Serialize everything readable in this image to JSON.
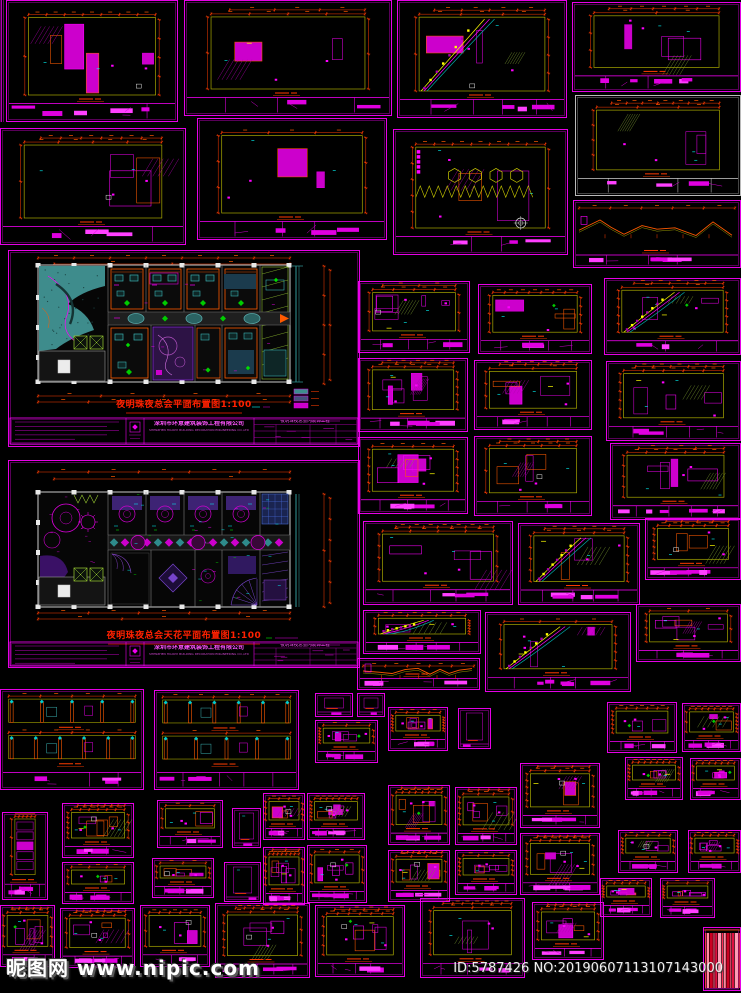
{
  "page": {
    "background": "#000000",
    "width": 741,
    "height": 993
  },
  "watermark": {
    "site_name": "昵图网",
    "site_url": "www.nipic.com",
    "image_id": "ID:5787426 NO:20190607113107143000"
  },
  "plans": {
    "p1": {
      "title": "夜明珠夜总会平面布置图1:100",
      "scale": "1:100",
      "type": "floor-plan"
    },
    "p2": {
      "title": "夜明珠夜总会天花平面布置图1:100",
      "scale": "1:100",
      "type": "ceiling-plan"
    }
  },
  "title_block": {
    "company_cn": "深圳市环意建筑装饰工程有限公司",
    "company_en": "SHENZHEN HUANYI BUILDING DECORATION ENGINEERING CO.,LTD",
    "project": "夜明珠夜总会内装饰工程"
  },
  "colors": {
    "sheet_border": "#ff00ff",
    "sheet_border_inner": "#b000b0",
    "white_border": "#cfcfcf",
    "dimension_red": "#ff3c00",
    "dimension_orange": "#ff5a00",
    "outline_olive": "#a8a800",
    "accent_cyan": "#00ffff",
    "accent_yellow": "#ffff00",
    "accent_green": "#00cc00",
    "teal_fill": "#3e8c8c",
    "violet": "#7744cc",
    "magenta_fill": "#cc00cc",
    "plan_title_red": "#ff2000",
    "swatch_pink": "#ff2a55"
  },
  "sheets": [
    {
      "x": 0,
      "y": 0,
      "w": 5,
      "h": 122,
      "b": "m",
      "k": "edge",
      "s": 1
    },
    {
      "x": 6,
      "y": 0,
      "w": 172,
      "h": 122,
      "b": "m",
      "k": "elev",
      "s": 11
    },
    {
      "x": 184,
      "y": 0,
      "w": 208,
      "h": 116,
      "b": "m",
      "k": "elev",
      "s": 12
    },
    {
      "x": 397,
      "y": 0,
      "w": 170,
      "h": 118,
      "b": "m",
      "k": "elevC",
      "s": 13
    },
    {
      "x": 572,
      "y": 2,
      "w": 169,
      "h": 90,
      "b": "m",
      "k": "elev",
      "s": 14
    },
    {
      "x": 0,
      "y": 128,
      "w": 186,
      "h": 117,
      "b": "m",
      "k": "elev",
      "s": 15
    },
    {
      "x": 197,
      "y": 118,
      "w": 190,
      "h": 122,
      "b": "m",
      "k": "elev",
      "s": 16
    },
    {
      "x": 393,
      "y": 129,
      "w": 175,
      "h": 126,
      "b": "m",
      "k": "elevH",
      "s": 17
    },
    {
      "x": 575,
      "y": 95,
      "w": 166,
      "h": 101,
      "b": "w",
      "k": "elev",
      "s": 18
    },
    {
      "x": 573,
      "y": 200,
      "w": 168,
      "h": 68,
      "b": "m",
      "k": "section",
      "s": 19
    },
    {
      "x": 8,
      "y": 250,
      "w": 352,
      "h": 197,
      "b": "m",
      "k": "plan1",
      "s": 0
    },
    {
      "x": 8,
      "y": 460,
      "w": 352,
      "h": 208,
      "b": "m",
      "k": "plan2",
      "s": 0
    },
    {
      "x": 358,
      "y": 281,
      "w": 112,
      "h": 72,
      "b": "m",
      "k": "elev",
      "s": 21
    },
    {
      "x": 478,
      "y": 284,
      "w": 114,
      "h": 70,
      "b": "m",
      "k": "elev",
      "s": 22
    },
    {
      "x": 358,
      "y": 358,
      "w": 110,
      "h": 74,
      "b": "m",
      "k": "elev",
      "s": 23
    },
    {
      "x": 474,
      "y": 360,
      "w": 118,
      "h": 70,
      "b": "m",
      "k": "elev",
      "s": 24
    },
    {
      "x": 358,
      "y": 437,
      "w": 110,
      "h": 77,
      "b": "m",
      "k": "elev",
      "s": 25
    },
    {
      "x": 474,
      "y": 436,
      "w": 118,
      "h": 80,
      "b": "m",
      "k": "elev",
      "s": 26
    },
    {
      "x": 604,
      "y": 278,
      "w": 137,
      "h": 77,
      "b": "m",
      "k": "elevC",
      "s": 27
    },
    {
      "x": 606,
      "y": 361,
      "w": 135,
      "h": 80,
      "b": "m",
      "k": "elev",
      "s": 28
    },
    {
      "x": 610,
      "y": 443,
      "w": 131,
      "h": 77,
      "b": "m",
      "k": "elev",
      "s": 29
    },
    {
      "x": 363,
      "y": 521,
      "w": 150,
      "h": 84,
      "b": "m",
      "k": "elev",
      "s": 30
    },
    {
      "x": 518,
      "y": 523,
      "w": 122,
      "h": 82,
      "b": "m",
      "k": "elevC",
      "s": 31
    },
    {
      "x": 645,
      "y": 518,
      "w": 96,
      "h": 62,
      "b": "m",
      "k": "elev",
      "s": 32
    },
    {
      "x": 363,
      "y": 610,
      "w": 118,
      "h": 44,
      "b": "m",
      "k": "elevC",
      "s": 34
    },
    {
      "x": 485,
      "y": 612,
      "w": 146,
      "h": 80,
      "b": "m",
      "k": "elevC",
      "s": 35
    },
    {
      "x": 636,
      "y": 604,
      "w": 105,
      "h": 58,
      "b": "m",
      "k": "elev",
      "s": 36
    },
    {
      "x": 357,
      "y": 658,
      "w": 123,
      "h": 32,
      "b": "m",
      "k": "section",
      "s": 37
    },
    {
      "x": 0,
      "y": 689,
      "w": 144,
      "h": 101,
      "b": "m",
      "k": "long2",
      "s": 38
    },
    {
      "x": 154,
      "y": 690,
      "w": 145,
      "h": 100,
      "b": "m",
      "k": "long2",
      "s": 39
    },
    {
      "x": 315,
      "y": 693,
      "w": 38,
      "h": 24,
      "b": "m",
      "k": "tiny",
      "s": 40
    },
    {
      "x": 357,
      "y": 693,
      "w": 28,
      "h": 24,
      "b": "m",
      "k": "tiny",
      "s": 41
    },
    {
      "x": 315,
      "y": 720,
      "w": 63,
      "h": 43,
      "b": "m",
      "k": "elev",
      "s": 42
    },
    {
      "x": 388,
      "y": 707,
      "w": 60,
      "h": 44,
      "b": "m",
      "k": "elev",
      "s": 43
    },
    {
      "x": 458,
      "y": 708,
      "w": 33,
      "h": 41,
      "b": "m",
      "k": "tiny",
      "s": 44
    },
    {
      "x": 607,
      "y": 702,
      "w": 70,
      "h": 51,
      "b": "m",
      "k": "elev",
      "s": 45
    },
    {
      "x": 682,
      "y": 703,
      "w": 59,
      "h": 49,
      "b": "m",
      "k": "elev",
      "s": 46
    },
    {
      "x": 625,
      "y": 757,
      "w": 58,
      "h": 43,
      "b": "m",
      "k": "elev",
      "s": 47
    },
    {
      "x": 690,
      "y": 758,
      "w": 51,
      "h": 42,
      "b": "m",
      "k": "elev",
      "s": 48
    },
    {
      "x": 263,
      "y": 793,
      "w": 42,
      "h": 47,
      "b": "m",
      "k": "elev",
      "s": 49
    },
    {
      "x": 307,
      "y": 793,
      "w": 58,
      "h": 47,
      "b": "m",
      "k": "elev",
      "s": 50
    },
    {
      "x": 263,
      "y": 847,
      "w": 42,
      "h": 58,
      "b": "m",
      "k": "elev",
      "s": 51
    },
    {
      "x": 307,
      "y": 845,
      "w": 60,
      "h": 58,
      "b": "m",
      "k": "elev",
      "s": 52
    },
    {
      "x": 388,
      "y": 785,
      "w": 62,
      "h": 60,
      "b": "m",
      "k": "elev",
      "s": 53
    },
    {
      "x": 388,
      "y": 850,
      "w": 62,
      "h": 52,
      "b": "m",
      "k": "elev",
      "s": 54
    },
    {
      "x": 455,
      "y": 787,
      "w": 62,
      "h": 58,
      "b": "m",
      "k": "elev",
      "s": 55
    },
    {
      "x": 455,
      "y": 850,
      "w": 62,
      "h": 45,
      "b": "m",
      "k": "elev",
      "s": 56
    },
    {
      "x": 520,
      "y": 763,
      "w": 80,
      "h": 65,
      "b": "m",
      "k": "elev",
      "s": 57
    },
    {
      "x": 520,
      "y": 833,
      "w": 80,
      "h": 62,
      "b": "m",
      "k": "elev",
      "s": 58
    },
    {
      "x": 2,
      "y": 812,
      "w": 46,
      "h": 88,
      "b": "m",
      "k": "tall",
      "s": 59
    },
    {
      "x": 62,
      "y": 803,
      "w": 72,
      "h": 55,
      "b": "m",
      "k": "elev",
      "s": 60
    },
    {
      "x": 62,
      "y": 862,
      "w": 72,
      "h": 42,
      "b": "m",
      "k": "elev",
      "s": 61
    },
    {
      "x": 157,
      "y": 800,
      "w": 66,
      "h": 48,
      "b": "m",
      "k": "elev",
      "s": 62
    },
    {
      "x": 232,
      "y": 808,
      "w": 29,
      "h": 40,
      "b": "m",
      "k": "tiny",
      "s": 63
    },
    {
      "x": 152,
      "y": 858,
      "w": 62,
      "h": 40,
      "b": "m",
      "k": "elev",
      "s": 64
    },
    {
      "x": 224,
      "y": 862,
      "w": 37,
      "h": 40,
      "b": "m",
      "k": "tiny",
      "s": 65
    },
    {
      "x": 618,
      "y": 830,
      "w": 60,
      "h": 43,
      "b": "m",
      "k": "elev",
      "s": 66
    },
    {
      "x": 688,
      "y": 830,
      "w": 53,
      "h": 43,
      "b": "m",
      "k": "elev",
      "s": 67
    },
    {
      "x": 600,
      "y": 878,
      "w": 52,
      "h": 39,
      "b": "m",
      "k": "elev",
      "s": 68
    },
    {
      "x": 660,
      "y": 878,
      "w": 55,
      "h": 40,
      "b": "m",
      "k": "elev",
      "s": 69
    },
    {
      "x": 0,
      "y": 905,
      "w": 55,
      "h": 62,
      "b": "m",
      "k": "elev",
      "s": 70
    },
    {
      "x": 60,
      "y": 908,
      "w": 75,
      "h": 60,
      "b": "m",
      "k": "elev",
      "s": 71
    },
    {
      "x": 140,
      "y": 905,
      "w": 70,
      "h": 62,
      "b": "m",
      "k": "elev",
      "s": 72
    },
    {
      "x": 215,
      "y": 903,
      "w": 95,
      "h": 75,
      "b": "m",
      "k": "elev",
      "s": 73
    },
    {
      "x": 315,
      "y": 905,
      "w": 90,
      "h": 72,
      "b": "m",
      "k": "elev",
      "s": 74
    },
    {
      "x": 420,
      "y": 898,
      "w": 105,
      "h": 80,
      "b": "m",
      "k": "elev",
      "s": 75
    },
    {
      "x": 532,
      "y": 902,
      "w": 72,
      "h": 58,
      "b": "m",
      "k": "elev",
      "s": 76
    },
    {
      "x": 703,
      "y": 927,
      "w": 38,
      "h": 64,
      "b": "m",
      "k": "swatch",
      "s": 78
    }
  ]
}
